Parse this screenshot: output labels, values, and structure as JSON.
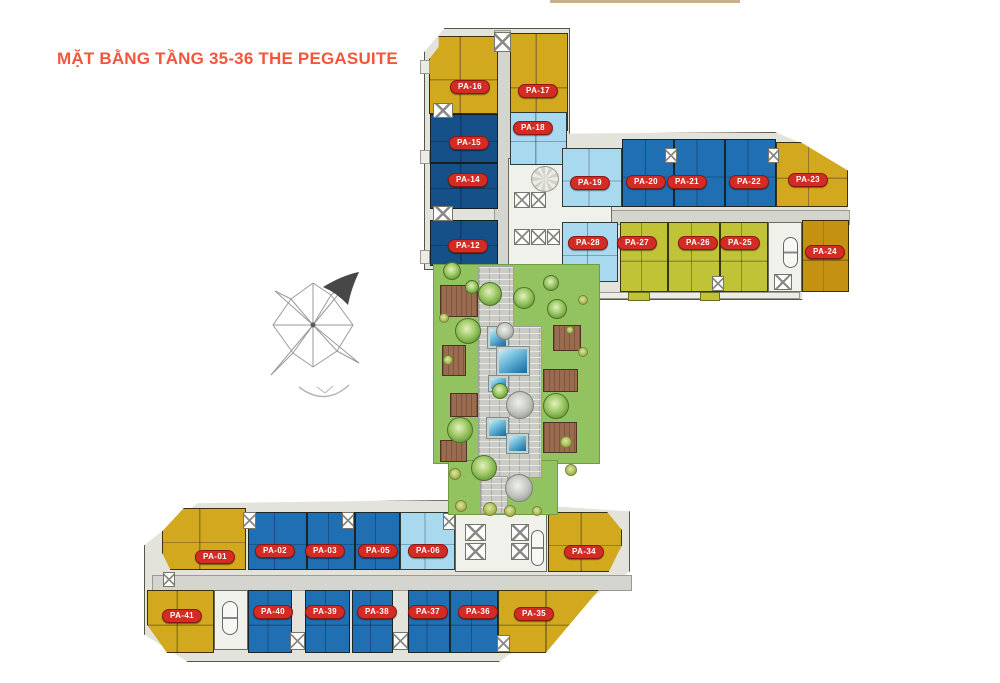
{
  "title": {
    "text": "MẶT BẰNG TẦNG 35-36 THE PEGASUITE"
  },
  "palette": {
    "title_color": "#f2563c",
    "badge_red": "#d22c25",
    "badge_border": "#8e1712",
    "yellow": "#d2a81e",
    "gold": "#c59110",
    "olive": "#c1c336",
    "blue": "#1f6fb2",
    "dark_blue": "#155089",
    "light_blue": "#a9d9ef",
    "lawn_green": "#93c361",
    "deck_brown": "#9b6b50",
    "corridor_gray": "#d4d5ce"
  },
  "compass": {
    "arrow_direction": "northeast"
  },
  "units": [
    {
      "id": "PA-01",
      "color": "yellow",
      "x": 215,
      "y": 557
    },
    {
      "id": "PA-02",
      "color": "blue",
      "x": 275,
      "y": 551
    },
    {
      "id": "PA-03",
      "color": "blue",
      "x": 325,
      "y": 551
    },
    {
      "id": "PA-05",
      "color": "blue",
      "x": 378,
      "y": 551
    },
    {
      "id": "PA-06",
      "color": "light_blue",
      "x": 428,
      "y": 551
    },
    {
      "id": "PA-12",
      "color": "dark_blue",
      "x": 468,
      "y": 246
    },
    {
      "id": "PA-14",
      "color": "dark_blue",
      "x": 468,
      "y": 180
    },
    {
      "id": "PA-15",
      "color": "dark_blue",
      "x": 469,
      "y": 143
    },
    {
      "id": "PA-16",
      "color": "yellow",
      "x": 470,
      "y": 87
    },
    {
      "id": "PA-17",
      "color": "yellow",
      "x": 538,
      "y": 91
    },
    {
      "id": "PA-18",
      "color": "light_blue",
      "x": 533,
      "y": 128
    },
    {
      "id": "PA-19",
      "color": "light_blue",
      "x": 590,
      "y": 183
    },
    {
      "id": "PA-20",
      "color": "blue",
      "x": 646,
      "y": 182
    },
    {
      "id": "PA-21",
      "color": "blue",
      "x": 687,
      "y": 182
    },
    {
      "id": "PA-22",
      "color": "blue",
      "x": 749,
      "y": 182
    },
    {
      "id": "PA-23",
      "color": "yellow",
      "x": 808,
      "y": 180
    },
    {
      "id": "PA-24",
      "color": "gold",
      "x": 825,
      "y": 252
    },
    {
      "id": "PA-25",
      "color": "olive",
      "x": 740,
      "y": 243
    },
    {
      "id": "PA-26",
      "color": "olive",
      "x": 698,
      "y": 243
    },
    {
      "id": "PA-27",
      "color": "olive",
      "x": 637,
      "y": 243
    },
    {
      "id": "PA-28",
      "color": "light_blue",
      "x": 588,
      "y": 243
    },
    {
      "id": "PA-34",
      "color": "yellow",
      "x": 584,
      "y": 552
    },
    {
      "id": "PA-35",
      "color": "yellow",
      "x": 534,
      "y": 614
    },
    {
      "id": "PA-36",
      "color": "blue",
      "x": 478,
      "y": 612
    },
    {
      "id": "PA-37",
      "color": "blue",
      "x": 428,
      "y": 612
    },
    {
      "id": "PA-38",
      "color": "blue",
      "x": 377,
      "y": 612
    },
    {
      "id": "PA-39",
      "color": "blue",
      "x": 325,
      "y": 612
    },
    {
      "id": "PA-40",
      "color": "blue",
      "x": 273,
      "y": 612
    },
    {
      "id": "PA-41",
      "color": "yellow",
      "x": 182,
      "y": 616
    }
  ],
  "courtyard": {
    "trees": [
      [
        452,
        271,
        9
      ],
      [
        472,
        287,
        7
      ],
      [
        490,
        294,
        12
      ],
      [
        524,
        298,
        11
      ],
      [
        551,
        283,
        8
      ],
      [
        468,
        331,
        13
      ],
      [
        557,
        309,
        10
      ],
      [
        500,
        391,
        8
      ],
      [
        556,
        406,
        13
      ],
      [
        460,
        430,
        13
      ],
      [
        484,
        468,
        13
      ]
    ],
    "gray_trees": [
      [
        505,
        331,
        9
      ],
      [
        520,
        405,
        14
      ],
      [
        519,
        488,
        14
      ]
    ],
    "bushes": [
      [
        444,
        318,
        5
      ],
      [
        448,
        360,
        5
      ],
      [
        570,
        330,
        4
      ],
      [
        583,
        300,
        5
      ],
      [
        583,
        352,
        5
      ],
      [
        455,
        474,
        6
      ],
      [
        566,
        442,
        6
      ],
      [
        571,
        470,
        6
      ],
      [
        461,
        506,
        6
      ],
      [
        490,
        509,
        7
      ],
      [
        510,
        511,
        6
      ],
      [
        537,
        511,
        5
      ]
    ],
    "pools": [
      [
        488,
        327,
        20,
        21
      ],
      [
        497,
        347,
        32,
        28
      ],
      [
        489,
        376,
        19,
        15
      ],
      [
        487,
        418,
        21,
        20
      ],
      [
        507,
        434,
        21,
        19
      ]
    ],
    "decks": [
      [
        440,
        285,
        38,
        32
      ],
      [
        442,
        345,
        24,
        31
      ],
      [
        553,
        325,
        28,
        26
      ],
      [
        543,
        369,
        35,
        23
      ],
      [
        450,
        393,
        28,
        24
      ],
      [
        440,
        440,
        27,
        22
      ],
      [
        543,
        422,
        34,
        31
      ]
    ]
  }
}
